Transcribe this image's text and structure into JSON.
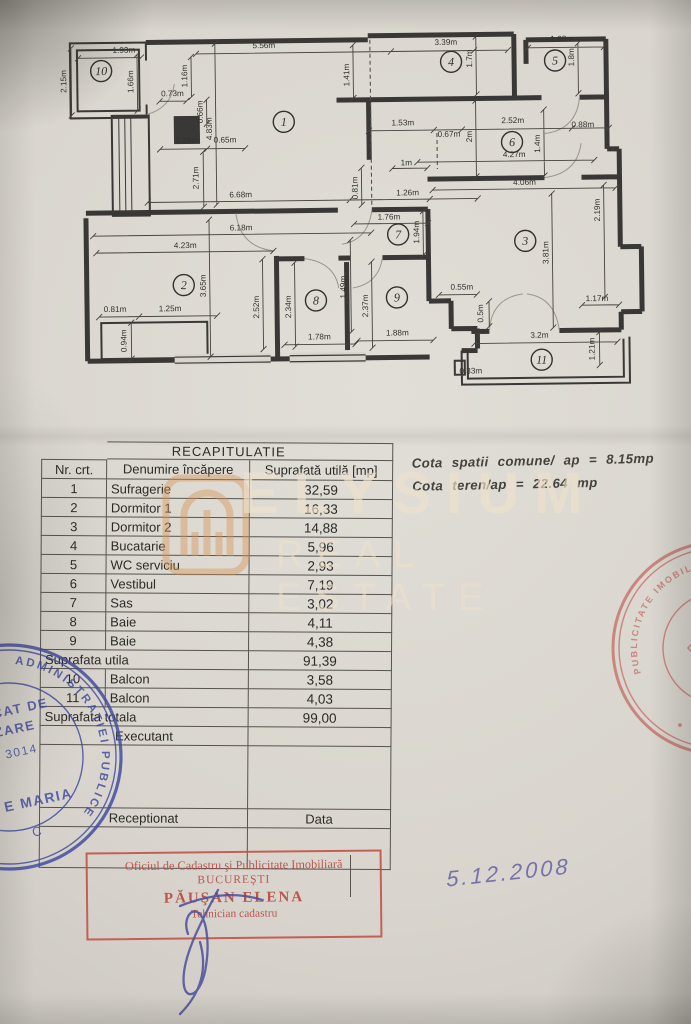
{
  "table": {
    "title": "RECAPITULATIE",
    "headers": [
      "Nr. crt.",
      "Denumire încăpere",
      "Suprafată utilă [mp]"
    ],
    "rows": [
      {
        "t": "d",
        "no": "1",
        "name": "Sufragerie",
        "area": "32,59"
      },
      {
        "t": "d",
        "no": "2",
        "name": "Dormitor 1",
        "area": "16,33"
      },
      {
        "t": "d",
        "no": "3",
        "name": "Dormitor 2",
        "area": "14,88"
      },
      {
        "t": "d",
        "no": "4",
        "name": "Bucatarie",
        "area": "5,96"
      },
      {
        "t": "d",
        "no": "5",
        "name": "WC serviciu",
        "area": "2,93"
      },
      {
        "t": "d",
        "no": "6",
        "name": "Vestibul",
        "area": "7,19"
      },
      {
        "t": "d",
        "no": "7",
        "name": "Sas",
        "area": "3,02"
      },
      {
        "t": "d",
        "no": "8",
        "name": "Baie",
        "area": "4,11"
      },
      {
        "t": "d",
        "no": "9",
        "name": "Baie",
        "area": "4,38"
      },
      {
        "t": "m",
        "label": "Suprafata utila",
        "area": "91,39"
      },
      {
        "t": "d",
        "no": "10",
        "name": "Balcon",
        "area": "3,58"
      },
      {
        "t": "d",
        "no": "11",
        "name": "Balcon",
        "area": "4,03"
      },
      {
        "t": "m",
        "label": "Suprafata totala",
        "area": "99,00"
      },
      {
        "t": "c",
        "label": "Executant",
        "area": ""
      },
      {
        "t": "sp",
        "h": 62
      },
      {
        "t": "c2",
        "label": "Receptionat",
        "area": "Data"
      },
      {
        "t": "sp",
        "h": 40
      }
    ]
  },
  "cota": {
    "line1": "Cota spatii comune/ ap = 8.15mp",
    "line2": "Cota teren/ap  = 22.64 mp"
  },
  "date_note": "5.12.2008",
  "stamps": {
    "office_box": {
      "line1": "Oficiul de Cadastru şi Publicitate Imobiliară",
      "line2": "BUCUREŞTI",
      "line3": "PĂUŞAN ELENA",
      "line4": "Tehnician cadastru"
    },
    "blue_round": {
      "ring_text": "ADMINISTRAŢIEI PUBLICE",
      "fragments": [
        "CAT DE",
        "ZARE",
        "3014",
        "E MARIA",
        "C"
      ]
    },
    "red_round": {
      "ring_top": "PUBLICITATE IMOBILIARA",
      "ring_bottom": "• ROMANIA •"
    }
  },
  "watermark": {
    "line1": "ELYSIUM",
    "line2": "REAL ESTATE"
  },
  "colors": {
    "paper": "#d9d5ce",
    "ink": "#33312e",
    "stamp_red": "#c2564b",
    "stamp_blue": "#3f4a9f",
    "watermark_cream": "#eee0cb",
    "watermark_orange": "#d6914f"
  },
  "plan": {
    "rooms": [
      {
        "n": "1",
        "x": 287,
        "y": 121
      },
      {
        "n": "2",
        "x": 185,
        "y": 283
      },
      {
        "n": "3",
        "x": 527,
        "y": 243
      },
      {
        "n": "4",
        "x": 455,
        "y": 63
      },
      {
        "n": "5",
        "x": 559,
        "y": 63
      },
      {
        "n": "6",
        "x": 515,
        "y": 144
      },
      {
        "n": "7",
        "x": 400,
        "y": 235
      },
      {
        "n": "8",
        "x": 317,
        "y": 300
      },
      {
        "n": "9",
        "x": 398,
        "y": 298
      },
      {
        "n": "10",
        "x": 105,
        "y": 68
      },
      {
        "n": "11",
        "x": 542,
        "y": 362
      }
    ],
    "labels": [
      {
        "t": "5.56m",
        "x": 268,
        "y": 47,
        "r": 0
      },
      {
        "t": "4.83m",
        "x": 215,
        "y": 127,
        "r": -90
      },
      {
        "t": "1.16m",
        "x": 191,
        "y": 74,
        "r": -90
      },
      {
        "t": "0.73m",
        "x": 176,
        "y": 94,
        "r": 0
      },
      {
        "t": "0.66m",
        "x": 206,
        "y": 110,
        "r": -90
      },
      {
        "t": "1.93m",
        "x": 128,
        "y": 50,
        "r": 0
      },
      {
        "t": "2.15m",
        "x": 70,
        "y": 78,
        "r": -90
      },
      {
        "t": "1.66m",
        "x": 137,
        "y": 79,
        "r": -90
      },
      {
        "t": "1.41m",
        "x": 353,
        "y": 75,
        "r": -90
      },
      {
        "t": "3.39m",
        "x": 450,
        "y": 46,
        "r": 0
      },
      {
        "t": "1.7m",
        "x": 476,
        "y": 60,
        "r": -90
      },
      {
        "t": "1.68m",
        "x": 566,
        "y": 44,
        "r": 0
      },
      {
        "t": "1.8m",
        "x": 578,
        "y": 60,
        "r": -90
      },
      {
        "t": "1.28m",
        "x": 190,
        "y": 141,
        "r": 0
      },
      {
        "t": "0.65m",
        "x": 228,
        "y": 141,
        "r": 0
      },
      {
        "t": "2.71m",
        "x": 201,
        "y": 176,
        "r": -90
      },
      {
        "t": "6.68m",
        "x": 243,
        "y": 196,
        "r": 0
      },
      {
        "t": "1.53m",
        "x": 406,
        "y": 126,
        "r": 0
      },
      {
        "t": "0.67m",
        "x": 452,
        "y": 138,
        "r": 0
      },
      {
        "t": "2m",
        "x": 475,
        "y": 138,
        "r": -90
      },
      {
        "t": "2.52m",
        "x": 516,
        "y": 125,
        "r": 0
      },
      {
        "t": "0.88m",
        "x": 586,
        "y": 130,
        "r": 0
      },
      {
        "t": "1.4m",
        "x": 543,
        "y": 146,
        "r": -90
      },
      {
        "t": "4.27m",
        "x": 517,
        "y": 159,
        "r": 0
      },
      {
        "t": "1m",
        "x": 409,
        "y": 166,
        "r": 0
      },
      {
        "t": "0.81m",
        "x": 360,
        "y": 188,
        "r": -90
      },
      {
        "t": "1.26m",
        "x": 410,
        "y": 196,
        "r": 0
      },
      {
        "t": "1.76m",
        "x": 391,
        "y": 220,
        "r": 0
      },
      {
        "t": "1.94m",
        "x": 421,
        "y": 233,
        "r": -90
      },
      {
        "t": "4.06m",
        "x": 527,
        "y": 187,
        "r": 0
      },
      {
        "t": "3.81m",
        "x": 550,
        "y": 255,
        "r": -90
      },
      {
        "t": "2.19m",
        "x": 602,
        "y": 213,
        "r": -90
      },
      {
        "t": "1.17m",
        "x": 598,
        "y": 304,
        "r": 0
      },
      {
        "t": "6.18m",
        "x": 243,
        "y": 229,
        "r": 0
      },
      {
        "t": "4.23m",
        "x": 187,
        "y": 246,
        "r": 0
      },
      {
        "t": "3.65m",
        "x": 207,
        "y": 284,
        "r": -90
      },
      {
        "t": "0.81m",
        "x": 116,
        "y": 309,
        "r": 0
      },
      {
        "t": "1.25m",
        "x": 171,
        "y": 309,
        "r": 0
      },
      {
        "t": "0.94m",
        "x": 127,
        "y": 338,
        "r": -90
      },
      {
        "t": "2.52m",
        "x": 260,
        "y": 306,
        "r": -90
      },
      {
        "t": "2.34m",
        "x": 292,
        "y": 306,
        "r": -90
      },
      {
        "t": "1.49m",
        "x": 347,
        "y": 287,
        "r": -90
      },
      {
        "t": "2.37m",
        "x": 369,
        "y": 306,
        "r": -90
      },
      {
        "t": "1.78m",
        "x": 320,
        "y": 339,
        "r": 0
      },
      {
        "t": "1.88m",
        "x": 398,
        "y": 336,
        "r": 0
      },
      {
        "t": "0.55m",
        "x": 463,
        "y": 291,
        "r": 0
      },
      {
        "t": "0.5m",
        "x": 484,
        "y": 315,
        "r": -90
      },
      {
        "t": "3.2m",
        "x": 540,
        "y": 340,
        "r": 0
      },
      {
        "t": "0.33m",
        "x": 471,
        "y": 375,
        "r": 0
      },
      {
        "t": "1.21m",
        "x": 595,
        "y": 352,
        "r": -90
      }
    ],
    "dimlines": [
      [
        200,
        52,
        478,
        52
      ],
      [
        150,
        200,
        480,
        200
      ],
      [
        95,
        233,
        373,
        233
      ],
      [
        98,
        250,
        275,
        250
      ],
      [
        100,
        314,
        218,
        314
      ],
      [
        285,
        344,
        356,
        344
      ],
      [
        358,
        341,
        434,
        341
      ],
      [
        356,
        224,
        430,
        224
      ],
      [
        352,
        200,
        432,
        200
      ],
      [
        395,
        169,
        430,
        169
      ],
      [
        420,
        163,
        597,
        163
      ],
      [
        435,
        191,
        618,
        191
      ],
      [
        372,
        131,
        612,
        131
      ],
      [
        395,
        52,
        512,
        52
      ],
      [
        532,
        50,
        608,
        50
      ],
      [
        583,
        308,
        620,
        308
      ],
      [
        475,
        345,
        618,
        345
      ],
      [
        440,
        296,
        478,
        296
      ],
      [
        163,
        147,
        248,
        147
      ],
      [
        82,
        55,
        145,
        55
      ],
      [
        163,
        99,
        190,
        99
      ],
      [
        219,
        42,
        219,
        203
      ],
      [
        75,
        45,
        75,
        112
      ],
      [
        141,
        52,
        141,
        108
      ],
      [
        195,
        55,
        195,
        95
      ],
      [
        210,
        98,
        210,
        122
      ],
      [
        206,
        150,
        206,
        205
      ],
      [
        357,
        45,
        357,
        98
      ],
      [
        480,
        38,
        480,
        96
      ],
      [
        582,
        46,
        582,
        96
      ],
      [
        479,
        102,
        479,
        178
      ],
      [
        547,
        112,
        547,
        178
      ],
      [
        364,
        168,
        364,
        205
      ],
      [
        425,
        212,
        425,
        256
      ],
      [
        211,
        218,
        211,
        355
      ],
      [
        132,
        320,
        132,
        356
      ],
      [
        264,
        258,
        264,
        348
      ],
      [
        296,
        262,
        296,
        346
      ],
      [
        352,
        240,
        352,
        332
      ],
      [
        373,
        262,
        373,
        348
      ],
      [
        554,
        196,
        554,
        330
      ],
      [
        606,
        188,
        606,
        300
      ],
      [
        600,
        335,
        600,
        368
      ],
      [
        490,
        303,
        490,
        328
      ]
    ],
    "ticks": [
      [
        140,
        314
      ],
      [
        210,
        147
      ],
      [
        437,
        131
      ],
      [
        465,
        131
      ],
      [
        575,
        131
      ]
    ]
  }
}
